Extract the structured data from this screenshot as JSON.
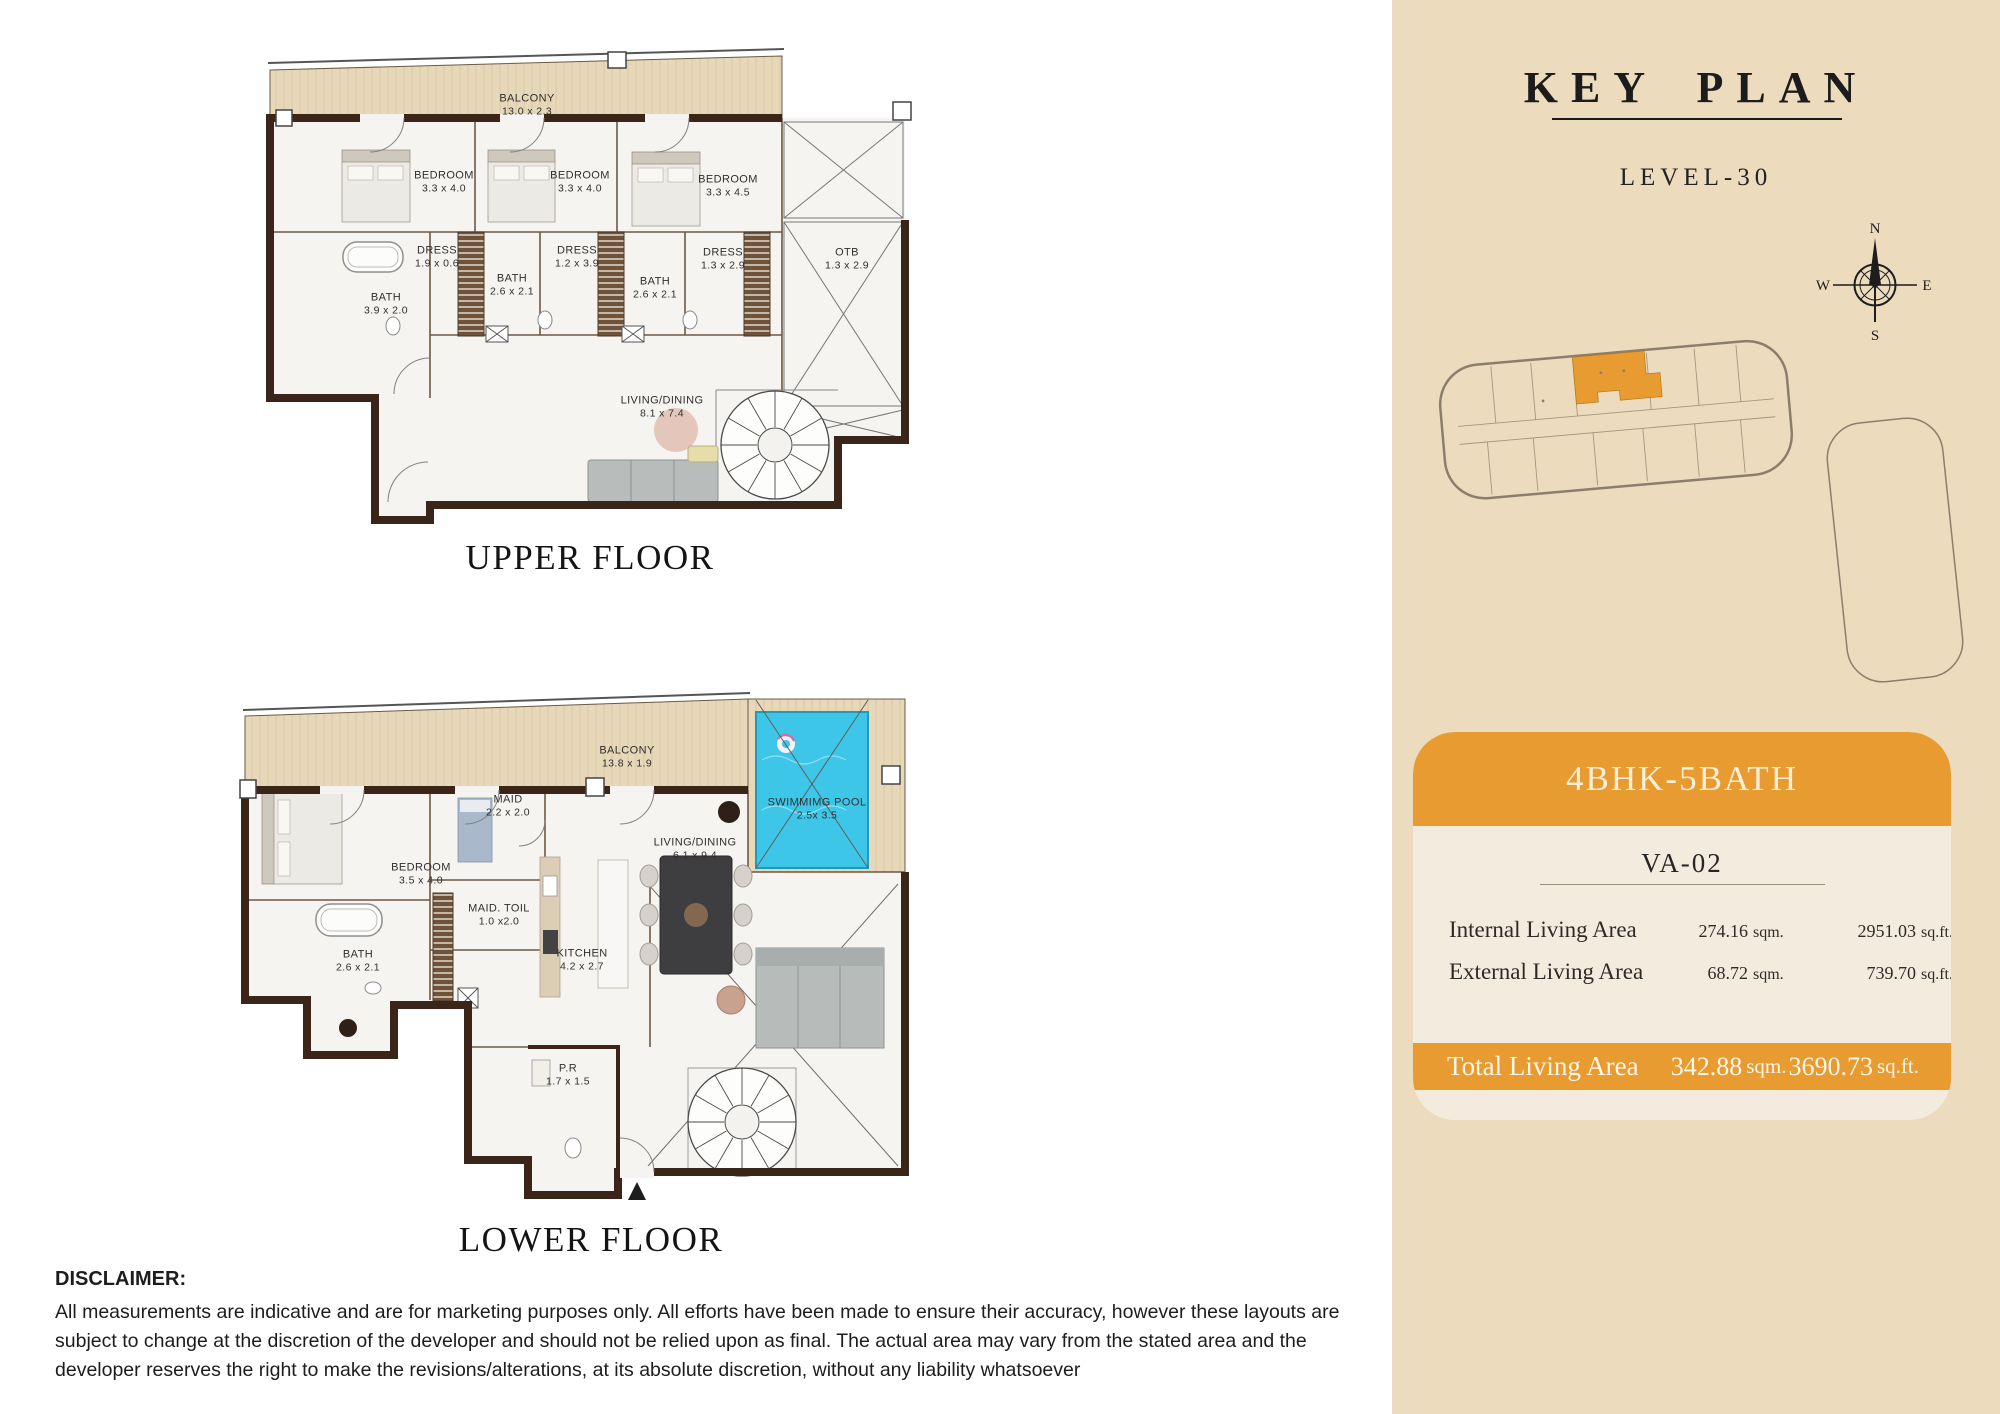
{
  "colors": {
    "accent": "#E89B31",
    "panel": "#ECDCBD",
    "card": "#F3ECDE",
    "wall": "#3B2418",
    "balcony": "#E7D8BA",
    "pool": "#3EC6E8",
    "outline": "#8B7E6C",
    "text_dark": "#1C1C1C"
  },
  "floors": {
    "upper": {
      "caption": "UPPER FLOOR",
      "rooms": [
        {
          "name": "BALCONY",
          "dims": "13.0 x 2.3"
        },
        {
          "name": "BEDROOM",
          "dims": "3.3 x 4.0"
        },
        {
          "name": "BEDROOM",
          "dims": "3.3 x 4.0"
        },
        {
          "name": "BEDROOM",
          "dims": "3.3 x 4.5"
        },
        {
          "name": "DRESS",
          "dims": "1.9 x 0.6"
        },
        {
          "name": "DRESS",
          "dims": "1.2 x 3.9"
        },
        {
          "name": "DRESS",
          "dims": "1.3 x 2.9"
        },
        {
          "name": "BATH",
          "dims": "3.9 x 2.0"
        },
        {
          "name": "BATH",
          "dims": "2.6 x 2.1"
        },
        {
          "name": "BATH",
          "dims": "2.6 x 2.1"
        },
        {
          "name": "OTB",
          "dims": "1.3 x 2.9"
        },
        {
          "name": "LIVING/DINING",
          "dims": "8.1 x 7.4"
        }
      ]
    },
    "lower": {
      "caption": "LOWER FLOOR",
      "rooms": [
        {
          "name": "BALCONY",
          "dims": "13.8 x 1.9"
        },
        {
          "name": "MAID",
          "dims": "2.2 x 2.0"
        },
        {
          "name": "BEDROOM",
          "dims": "3.5 x 4.0"
        },
        {
          "name": "MAID. TOIL",
          "dims": "1.0 x2.0"
        },
        {
          "name": "BATH",
          "dims": "2.6 x 2.1"
        },
        {
          "name": "KITCHEN",
          "dims": "4.2 x 2.7"
        },
        {
          "name": "LIVING/DINING",
          "dims": "6.1 x 9.4"
        },
        {
          "name": "SWIMMIMG POOL",
          "dims": "2.5x 3.5"
        },
        {
          "name": "P.R",
          "dims": "1.7 x 1.5"
        }
      ]
    }
  },
  "key_plan": {
    "title": "KEY PLAN",
    "level": "LEVEL-30",
    "compass": {
      "n": "N",
      "e": "E",
      "s": "S",
      "w": "W"
    }
  },
  "unit_card": {
    "type": "4BHK-5BATH",
    "unit": "VA-02",
    "rows": [
      {
        "label": "Internal Living Area",
        "sqm": "274.16",
        "sqm_unit": "sqm.",
        "sqft": "2951.03",
        "sqft_unit": "sq.ft."
      },
      {
        "label": "External Living Area",
        "sqm": "68.72",
        "sqm_unit": "sqm.",
        "sqft": "739.70",
        "sqft_unit": "sq.ft."
      }
    ],
    "total": {
      "label": "Total Living Area",
      "sqm": "342.88",
      "sqm_unit": "sqm.",
      "sqft": "3690.73",
      "sqft_unit": "sq.ft."
    }
  },
  "disclaimer": {
    "heading": "DISCLAIMER:",
    "body": "All measurements are indicative and are for marketing purposes only. All efforts have been made to ensure their accuracy, however these layouts are subject to change at the discretion of the developer and should not be relied upon as final. The actual area may vary from the stated area and the developer reserves the right to make the revisions/alterations, at its absolute discretion, without any liability whatsoever"
  }
}
